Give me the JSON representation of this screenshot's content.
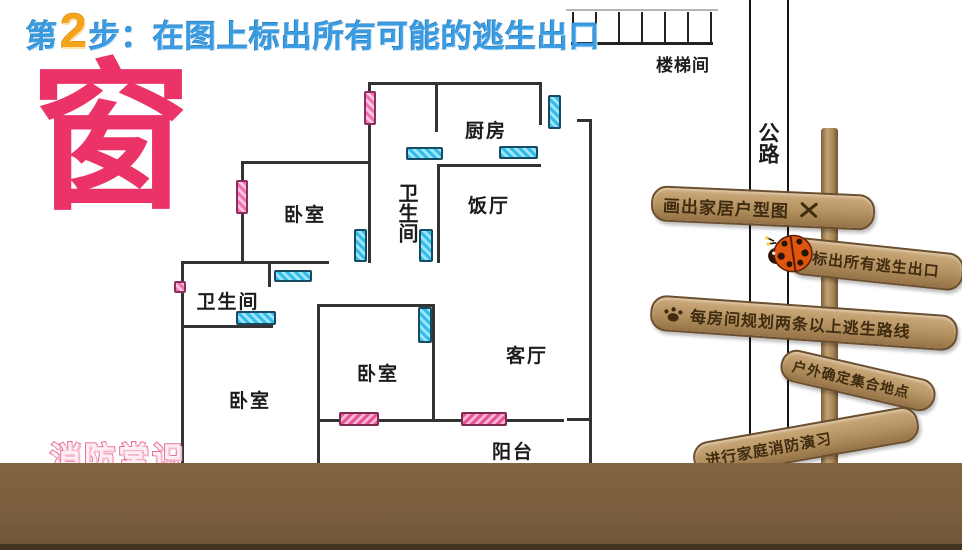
{
  "title": {
    "step_prefix": "第",
    "step_number": "2",
    "step_text": "步：在图上标出所有可能的逃生出口"
  },
  "big_char": "窗",
  "watermark": "消防常识",
  "floorplan": {
    "rooms": [
      {
        "name": "kitchen",
        "label": "厨房"
      },
      {
        "name": "dining-room",
        "label": "饭厅"
      },
      {
        "name": "bathroom-upper",
        "label": "卫生间"
      },
      {
        "name": "bedroom-upper-left",
        "label": "卧室"
      },
      {
        "name": "bathroom-lower",
        "label": "卫生间"
      },
      {
        "name": "bedroom-middle",
        "label": "卧室"
      },
      {
        "name": "bedroom-lower-left",
        "label": "卧室"
      },
      {
        "name": "living-room",
        "label": "客厅"
      },
      {
        "name": "balcony",
        "label": "阳台"
      },
      {
        "name": "stairwell",
        "label": "楼梯间"
      },
      {
        "name": "road",
        "label": "公路"
      }
    ],
    "legend": {
      "cyan_rect": "window",
      "pink_rect": "door-exit"
    }
  },
  "signpost": {
    "signs": [
      {
        "text": "画出家居户型图",
        "icon": "x-mark"
      },
      {
        "text": "标出所有逃生出口",
        "icon": "ladybug"
      },
      {
        "text": "每房间规划两条以上逃生路线",
        "icon": "paw"
      },
      {
        "text": "户外确定集合地点",
        "icon": ""
      },
      {
        "text": "进行家庭消防演习",
        "icon": ""
      }
    ]
  },
  "colors": {
    "title_blue": "#3a9be0",
    "step_orange": "#f6a31c",
    "char_pink": "#eb3368",
    "window_cyan": "#35bdea",
    "door_pink": "#f173b2",
    "wood": "#b3905f",
    "band_brown": "#7a5e3d"
  }
}
